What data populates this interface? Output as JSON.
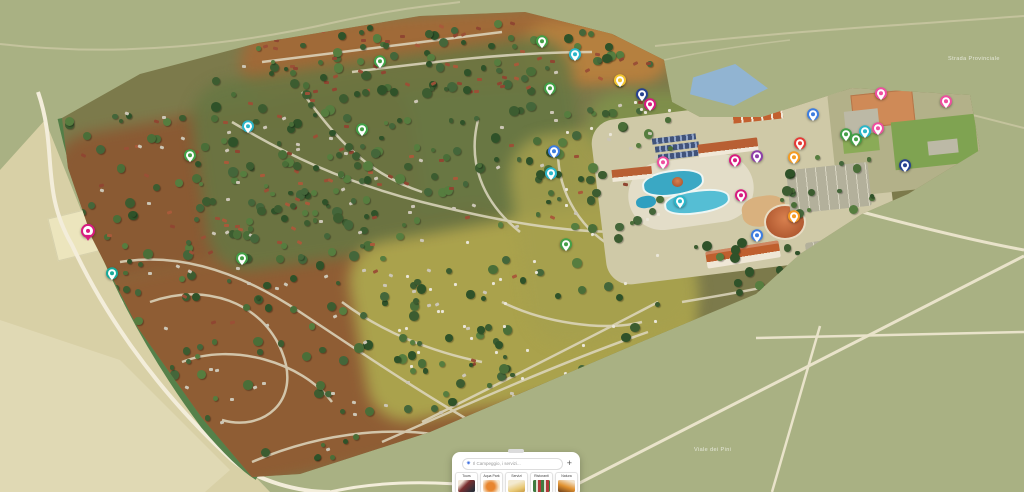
{
  "palette": {
    "cyan": "#2bb6c9",
    "green": "#43a047",
    "magenta": "#d81b7f",
    "red": "#e53935",
    "orange": "#f59b23",
    "yellow": "#f2c430",
    "navy": "#26418f",
    "purple": "#8e3fa8",
    "blue": "#3d7de0",
    "teal": "#17a99a",
    "pink": "#ef4fa0",
    "terrain": "#a9b183",
    "campsite_brown": "#8a5a33",
    "camp_field": "#aaa24c",
    "pool_blue": "#3aa8c4",
    "roof_orange": "#bf5f2e"
  },
  "map": {
    "markers": [
      {
        "x": 248,
        "y": 128,
        "color": "cyan"
      },
      {
        "x": 362,
        "y": 131,
        "color": "green"
      },
      {
        "x": 190,
        "y": 157,
        "color": "green"
      },
      {
        "x": 380,
        "y": 63,
        "color": "green"
      },
      {
        "x": 542,
        "y": 43,
        "color": "green"
      },
      {
        "x": 575,
        "y": 56,
        "color": "cyan"
      },
      {
        "x": 620,
        "y": 82,
        "color": "yellow"
      },
      {
        "x": 642,
        "y": 96,
        "color": "navy"
      },
      {
        "x": 650,
        "y": 106,
        "color": "magenta"
      },
      {
        "x": 550,
        "y": 90,
        "color": "green"
      },
      {
        "x": 554,
        "y": 153,
        "color": "blue"
      },
      {
        "x": 551,
        "y": 175,
        "color": "cyan"
      },
      {
        "x": 663,
        "y": 164,
        "color": "pink"
      },
      {
        "x": 566,
        "y": 246,
        "color": "green"
      },
      {
        "x": 88,
        "y": 233,
        "color": "magenta",
        "shape": "pin"
      },
      {
        "x": 112,
        "y": 275,
        "color": "teal"
      },
      {
        "x": 242,
        "y": 260,
        "color": "green"
      },
      {
        "x": 735,
        "y": 162,
        "color": "magenta"
      },
      {
        "x": 757,
        "y": 158,
        "color": "purple"
      },
      {
        "x": 800,
        "y": 145,
        "color": "red"
      },
      {
        "x": 846,
        "y": 136,
        "color": "green"
      },
      {
        "x": 856,
        "y": 141,
        "color": "green"
      },
      {
        "x": 794,
        "y": 159,
        "color": "orange"
      },
      {
        "x": 741,
        "y": 197,
        "color": "magenta"
      },
      {
        "x": 680,
        "y": 203,
        "color": "cyan"
      },
      {
        "x": 794,
        "y": 218,
        "color": "orange"
      },
      {
        "x": 757,
        "y": 237,
        "color": "blue"
      },
      {
        "x": 865,
        "y": 133,
        "color": "cyan"
      },
      {
        "x": 881,
        "y": 95,
        "color": "pink"
      },
      {
        "x": 946,
        "y": 103,
        "color": "pink"
      },
      {
        "x": 878,
        "y": 130,
        "color": "pink"
      },
      {
        "x": 905,
        "y": 167,
        "color": "navy"
      },
      {
        "x": 813,
        "y": 116,
        "color": "blue"
      }
    ],
    "road_labels": [
      {
        "text": "Strada Provinciale",
        "x": 948,
        "y": 56
      },
      {
        "text": "Viale dei Pini",
        "x": 694,
        "y": 447
      }
    ]
  },
  "toolbar": {
    "search_placeholder": "Il Campeggio, i servizi...",
    "search_icon": "sparkle-search",
    "add_button": "+",
    "categories": [
      {
        "label": "Tours"
      },
      {
        "label": "Aqua Park"
      },
      {
        "label": "Servizi"
      },
      {
        "label": "Ristoranti"
      },
      {
        "label": "Natura"
      }
    ]
  },
  "decor": {
    "tree_colors": [
      "#3c5c30",
      "#4a6e38",
      "#567d3f",
      "#2f5229",
      "#44663a"
    ],
    "hut_colors": [
      "#9a5036",
      "#a85a3a",
      "#8f4631"
    ],
    "caravan_color": "#ccc6b6",
    "tent_color": "#eae6d8",
    "zones": [
      {
        "x": 250,
        "y": 20,
        "w": 400,
        "h": 72,
        "trees": 65,
        "huts": 48,
        "caravans": 0,
        "tents": 0
      },
      {
        "x": 65,
        "y": 112,
        "w": 350,
        "h": 145,
        "trees": 95,
        "huts": 40,
        "caravans": 18,
        "tents": 0
      },
      {
        "x": 105,
        "y": 255,
        "w": 410,
        "h": 205,
        "trees": 95,
        "huts": 8,
        "caravans": 55,
        "tents": 0
      },
      {
        "x": 210,
        "y": 60,
        "w": 350,
        "h": 185,
        "trees": 85,
        "huts": 18,
        "caravans": 22,
        "tents": 0
      },
      {
        "x": 390,
        "y": 240,
        "w": 270,
        "h": 145,
        "trees": 28,
        "huts": 0,
        "caravans": 0,
        "tents": 30
      },
      {
        "x": 540,
        "y": 100,
        "w": 130,
        "h": 135,
        "trees": 32,
        "huts": 4,
        "caravans": 8,
        "tents": 12
      },
      {
        "x": 775,
        "y": 150,
        "w": 95,
        "h": 60,
        "trees": 20,
        "huts": 0,
        "caravans": 0,
        "tents": 0
      },
      {
        "x": 690,
        "y": 230,
        "w": 120,
        "h": 70,
        "trees": 16,
        "huts": 0,
        "caravans": 0,
        "tents": 0
      }
    ]
  }
}
